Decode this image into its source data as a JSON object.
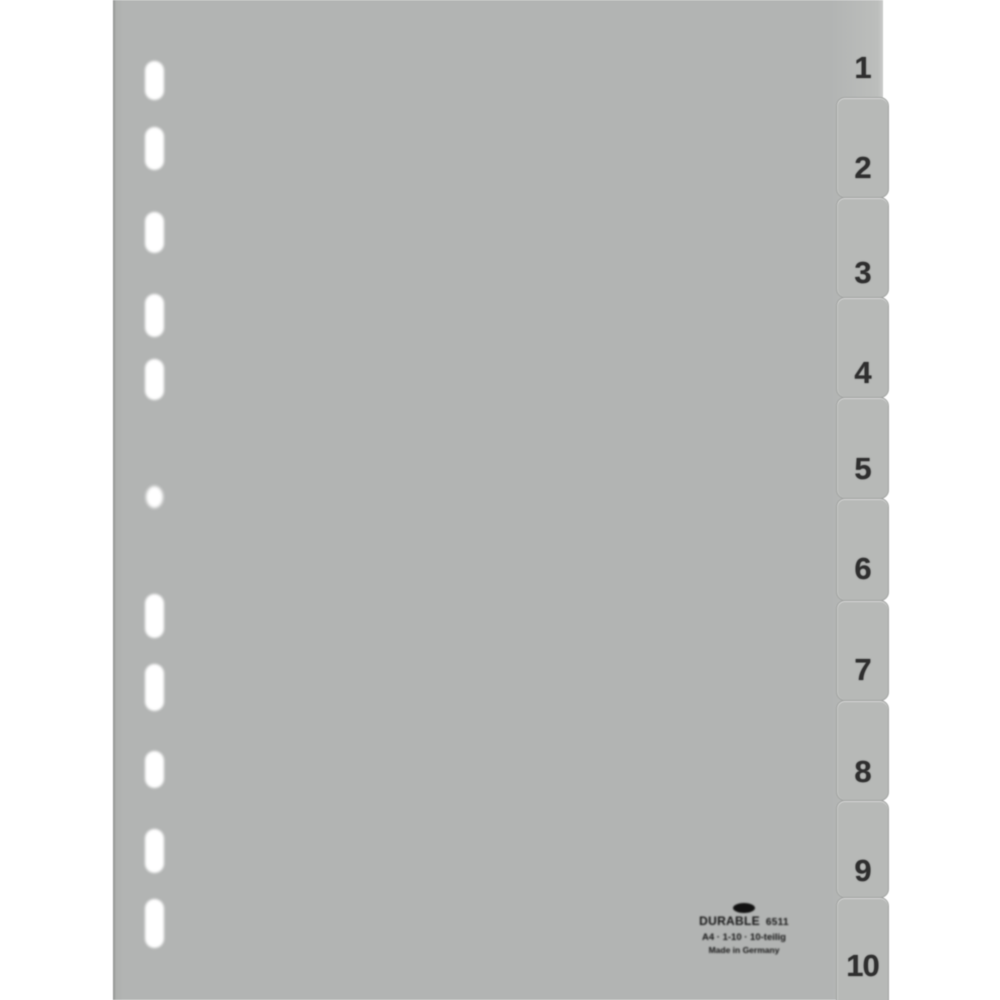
{
  "tabs": {
    "labels": [
      "1",
      "2",
      "3",
      "4",
      "5",
      "6",
      "7",
      "8",
      "9",
      "10"
    ]
  },
  "brand_print": {
    "name": "DURABLE",
    "code": "6511",
    "line2": "A4 · 1-10 · 10-teilig",
    "line3": "Made in Germany"
  },
  "counts": {
    "tabs": 10,
    "punch_holes": 11
  },
  "colors": {
    "background": "#ffffff",
    "sheet_grey": "#b2b4b3",
    "tab_grey": "#b7b9b7",
    "tab_border_grey": "#a2a4a2",
    "number_ink": "#2f2f2f",
    "print_ink": "#161616",
    "hole_white": "#ffffff"
  }
}
